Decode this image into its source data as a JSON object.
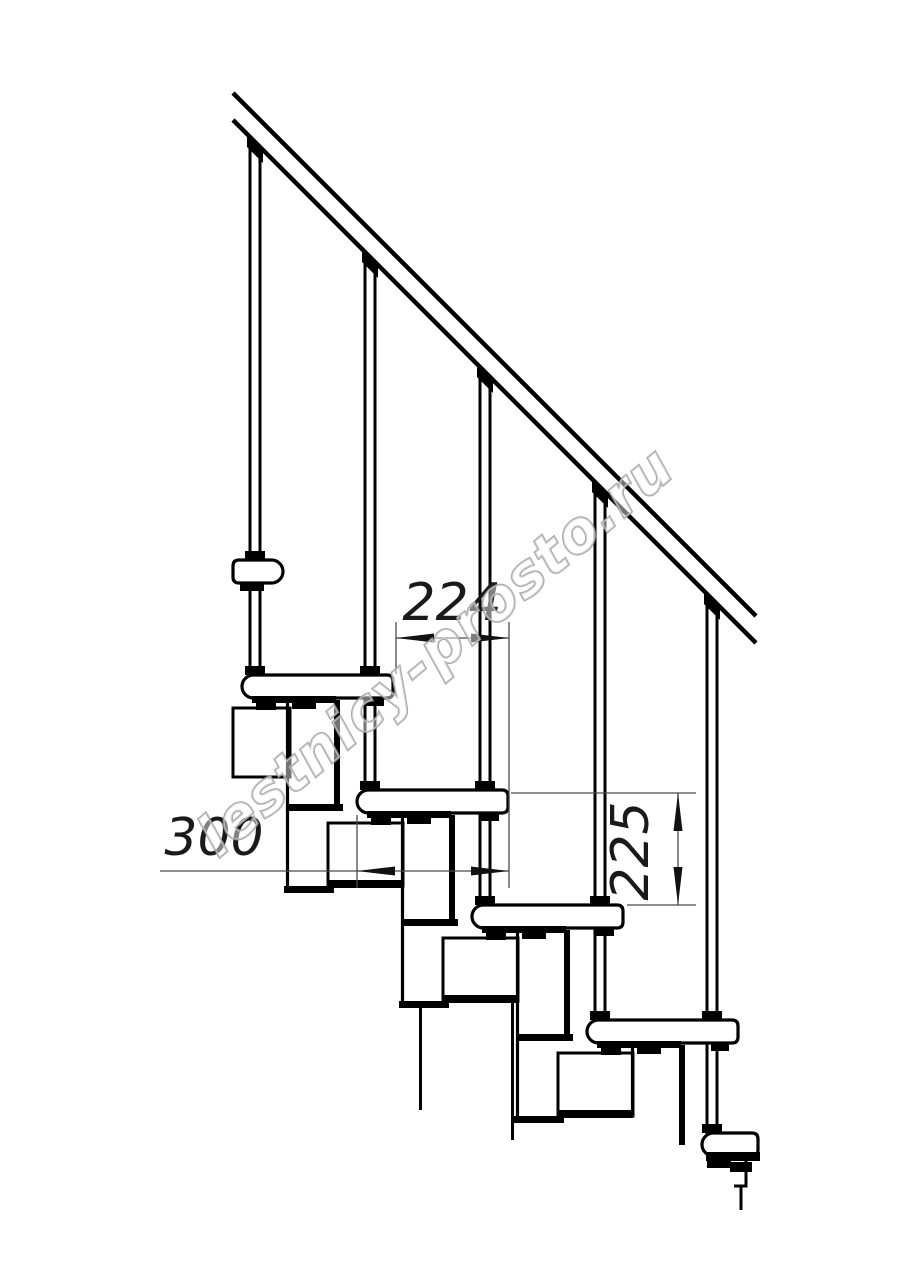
{
  "page": {
    "width": 914,
    "height": 1280,
    "background": "#ffffff"
  },
  "drawing": {
    "title": "staircase-side-view-technical-drawing",
    "ink_color": "#000000",
    "thin_line_color": "#4a4a4a",
    "dim_text_color": "#1a1a1a",
    "handrail": {
      "x1": 233,
      "y_top1": 93,
      "y_bot1": 120,
      "x2": 756,
      "y_top2": 616,
      "y_bot2": 643,
      "stroke_w": 4.5
    },
    "balusters": {
      "centers_x": [
        255,
        370,
        485,
        600,
        712
      ],
      "half_gap": 5,
      "stroke_w": 3,
      "rail_base_x": 233,
      "rail_base_y": 120,
      "cap_half_w": 8,
      "cap_h": 11
    },
    "tread_tops": [
      560,
      675,
      790,
      905,
      1020,
      1133
    ],
    "treads": [
      {
        "x": 233,
        "y": 560,
        "w": 50,
        "round": "right"
      },
      {
        "x": 242,
        "y": 675,
        "w": 151,
        "round": "left"
      },
      {
        "x": 357,
        "y": 790,
        "w": 151,
        "round": "left"
      },
      {
        "x": 472,
        "y": 905,
        "w": 151,
        "round": "left"
      },
      {
        "x": 587,
        "y": 1020,
        "w": 151,
        "round": "left"
      },
      {
        "x": 702,
        "y": 1133,
        "w": 56,
        "round": "left"
      }
    ],
    "tread_h": 23,
    "understrip_tread_indexes": [
      1,
      2,
      3,
      4
    ],
    "custom_understrips": [
      [
        240,
        583,
        24,
        8
      ],
      [
        706,
        1152,
        54,
        9
      ],
      [
        707,
        1160,
        24,
        8
      ],
      [
        730,
        1162,
        22,
        10
      ]
    ],
    "modules": {
      "units": [
        {
          "x": 242,
          "yb": 698
        },
        {
          "x": 357,
          "yb": 813
        },
        {
          "x": 472,
          "yb": 928
        },
        {
          "x": 587,
          "yb": 1043,
          "wall_h": 100,
          "left_line": [
            1047,
            1115
          ],
          "skip_plate": true,
          "skip_bottom": true,
          "skip_box": true
        }
      ],
      "upper_box": [
        233,
        708,
        57,
        69
      ],
      "dangling_lines": [
        [
          420.5,
          1008,
          1110
        ],
        [
          512.5,
          1003,
          1140
        ]
      ]
    },
    "bottom_outline_path": "M746 1161 L746 1186 L734 1186 M741 1186 L741 1210",
    "dimensions": [
      {
        "id": "step-run",
        "label": "224",
        "value_mm": 224,
        "orientation": "horizontal",
        "line": {
          "y": 638,
          "x1": 396,
          "x2": 509
        },
        "tips": [
          396,
          509
        ],
        "ext_v": [
          [
            396,
            622,
            674
          ],
          [
            509,
            622,
            888
          ]
        ],
        "text": {
          "x": 452,
          "y": 620,
          "size": 52
        }
      },
      {
        "id": "tread-depth",
        "label": "300",
        "value_mm": 300,
        "orientation": "horizontal",
        "line": {
          "y": 871,
          "x1": 160,
          "x2": 509
        },
        "tips": [
          357,
          509
        ],
        "ext_v": [
          [
            357,
            815,
            888
          ]
        ],
        "text": {
          "x": 214,
          "y": 855,
          "size": 52
        }
      },
      {
        "id": "step-rise",
        "label": "225",
        "value_mm": 225,
        "orientation": "vertical",
        "line": {
          "x": 678,
          "y1": 793,
          "y2": 905
        },
        "tips": [
          793,
          905
        ],
        "ext_h": [
          [
            793,
            511,
            696
          ],
          [
            905,
            627,
            696
          ]
        ],
        "text": {
          "x": 648,
          "y": 851,
          "size": 52,
          "rotate": -90
        }
      }
    ],
    "arrow": {
      "len": 38,
      "half_w": 4.5
    }
  },
  "watermark": {
    "text": "lestnicy-prosto.ru",
    "cx": 448,
    "cy": 666,
    "angle_deg": -40,
    "font_size": 57,
    "fill": "#ffffff",
    "fill_opacity": 0.45,
    "stroke": "#9b9b9b",
    "stroke_opacity": 0.85,
    "stroke_width": 2.2
  }
}
